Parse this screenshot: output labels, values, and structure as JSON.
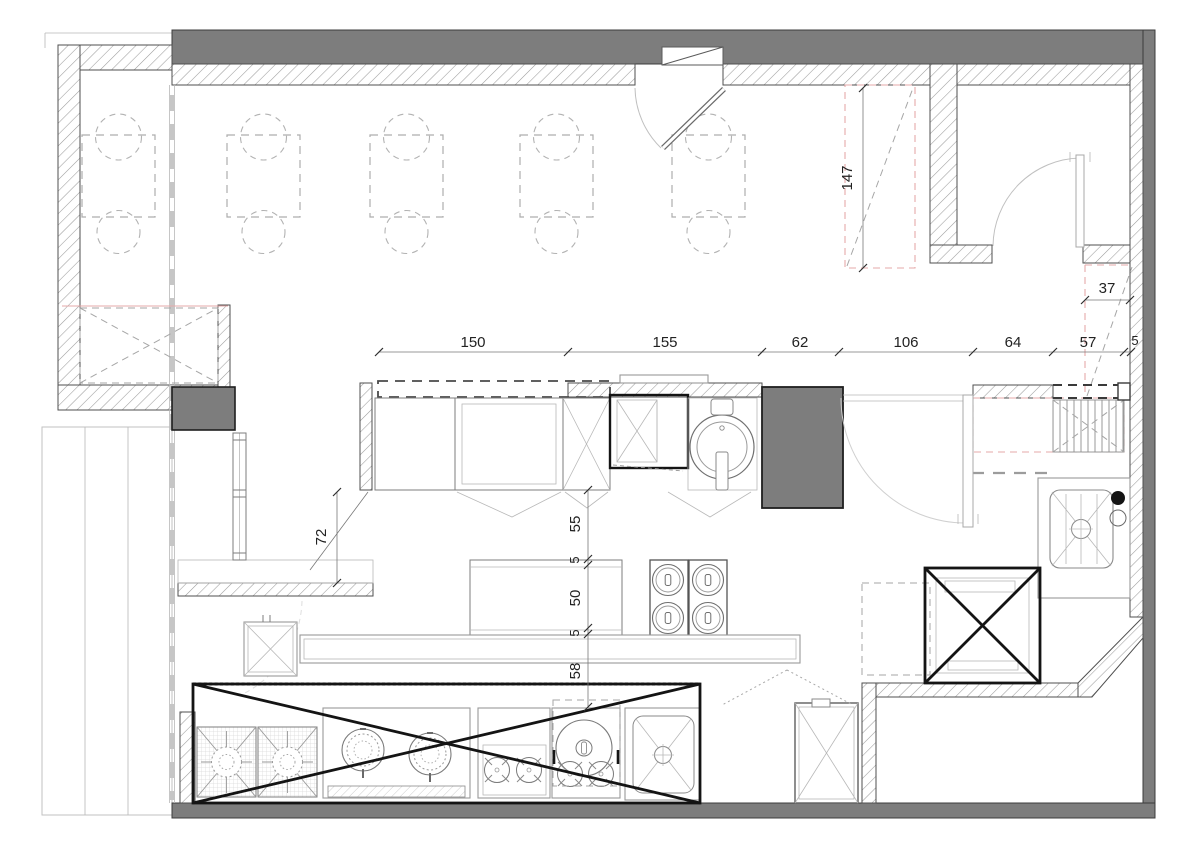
{
  "colors": {
    "wall_fill": "#7d7d7d",
    "hatch_line": "#9c9c9c",
    "accent_red": "#e5a9a9",
    "dim_text": "#222222",
    "bold_mark": "#141414"
  },
  "dims": {
    "h150": "150",
    "h155": "155",
    "h62": "62",
    "h106": "106",
    "h64": "64",
    "h57": "57",
    "h5": "5",
    "v147": "147",
    "v37": "37",
    "v72": "72",
    "v55": "55",
    "v5a": "5",
    "v50": "50",
    "v5b": "5",
    "v58": "58"
  }
}
